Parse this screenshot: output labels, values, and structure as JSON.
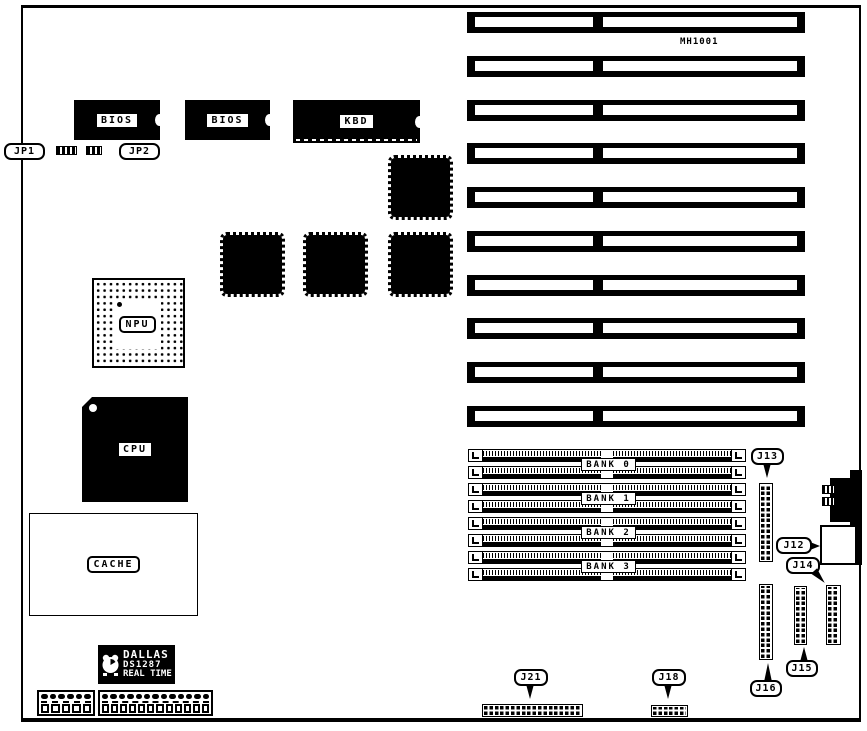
{
  "colors": {
    "ink": "#000000",
    "background": "#ffffff"
  },
  "board_label": "MH1001",
  "chips": {
    "bios1_label": "BIOS",
    "bios2_label": "BIOS",
    "kbd_label": "KBD",
    "npu_label": "NPU",
    "cpu_label": "CPU",
    "cache_label": "CACHE"
  },
  "rtc": {
    "brand": "DALLAS",
    "part": "DS1287",
    "type": "REAL TIME"
  },
  "jumpers": {
    "jp1": "JP1",
    "jp2": "JP2"
  },
  "isa": {
    "slot_count": 10
  },
  "memory": {
    "simm_socket_count": 8
  },
  "memory_banks": [
    {
      "label": "BANK 0"
    },
    {
      "label": "BANK 1"
    },
    {
      "label": "BANK 2"
    },
    {
      "label": "BANK 3"
    }
  ],
  "connectors": {
    "j12": "J12",
    "j13": "J13",
    "j14": "J14",
    "j15": "J15",
    "j16": "J16",
    "j18": "J18",
    "j21": "J21"
  }
}
